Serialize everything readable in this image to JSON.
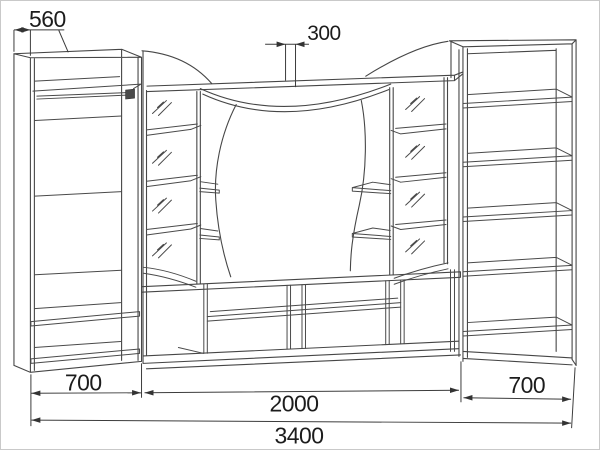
{
  "drawing": {
    "type": "furniture-technical-line-drawing",
    "colors": {
      "line": "#464646",
      "dimension_line": "#3c3c3c",
      "text": "#1c1c1c",
      "background": "#ffffff",
      "frame_border": "#c9c9c9"
    },
    "dimensions": {
      "wardrobe_depth": "560",
      "top_overhang": "300",
      "left_section_width": "700",
      "center_section_width": "2000",
      "right_section_width": "700",
      "total_width": "3400"
    }
  }
}
